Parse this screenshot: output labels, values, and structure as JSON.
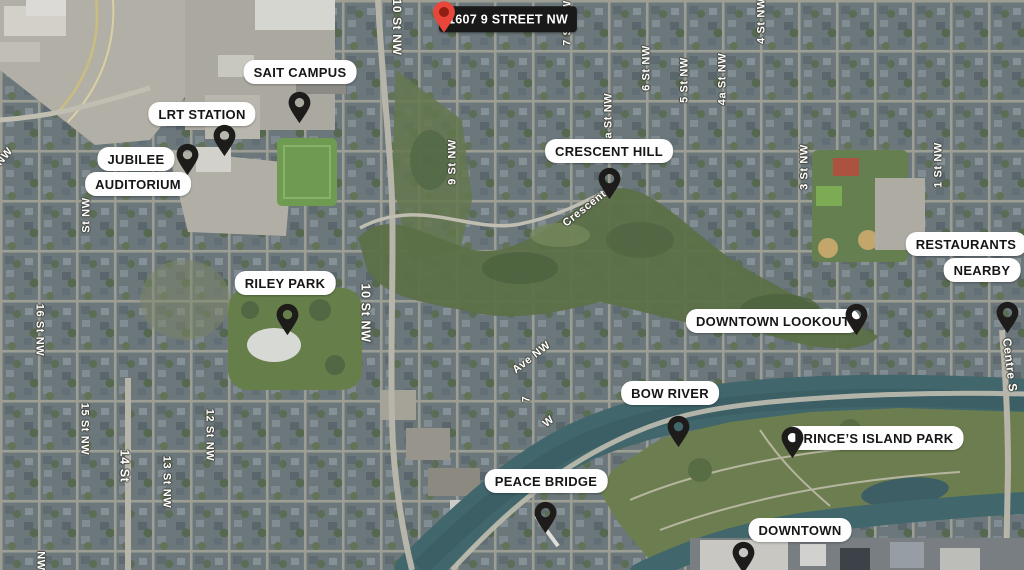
{
  "map": {
    "title": "1607 9 Street NW area map",
    "colors": {
      "pin_black": "#1d1c1a",
      "pin_red": "#e8463a",
      "pin_red_inner": "#8e1f12",
      "label_bg": "#fefefe",
      "label_text": "#161616",
      "address_bg": "#191919",
      "address_text": "#ffffff",
      "street_text": "#ffffff",
      "water": "#3f666b"
    },
    "markers": [
      {
        "name": "address-1607-9-street-nw",
        "pin": {
          "x": 444,
          "y": 34,
          "color": "red",
          "w": 28,
          "h": 34
        },
        "labels": [
          {
            "text": "1607 9 STREET NW",
            "x": 508,
            "y": 19,
            "style": "dark"
          }
        ]
      },
      {
        "name": "sait-campus",
        "pin": {
          "x": 299,
          "y": 125,
          "color": "black"
        },
        "labels": [
          {
            "text": "SAIT CAMPUS",
            "x": 300,
            "y": 72
          }
        ]
      },
      {
        "name": "lrt-station",
        "pin": {
          "x": 224,
          "y": 158,
          "color": "black"
        },
        "labels": [
          {
            "text": "LRT STATION",
            "x": 202,
            "y": 114
          }
        ]
      },
      {
        "name": "jubilee-auditorium",
        "pin": {
          "x": 187,
          "y": 177,
          "color": "black"
        },
        "labels": [
          {
            "text": "JUBILEE",
            "x": 136,
            "y": 159
          },
          {
            "text": "AUDITORIUM",
            "x": 138,
            "y": 184
          }
        ]
      },
      {
        "name": "crescent-hill",
        "pin": {
          "x": 609,
          "y": 201,
          "color": "black"
        },
        "labels": [
          {
            "text": "CRESCENT HILL",
            "x": 609,
            "y": 151
          }
        ]
      },
      {
        "name": "riley-park",
        "pin": {
          "x": 287,
          "y": 337,
          "color": "black"
        },
        "labels": [
          {
            "text": "RILEY PARK",
            "x": 285,
            "y": 283
          }
        ]
      },
      {
        "name": "downtown-lookout",
        "pin": {
          "x": 856,
          "y": 337,
          "color": "black"
        },
        "labels": [
          {
            "text": "DOWNTOWN LOOKOUT",
            "x": 773,
            "y": 321
          }
        ]
      },
      {
        "name": "restaurants-nearby",
        "pin": {
          "x": 1007,
          "y": 335,
          "color": "black"
        },
        "labels": [
          {
            "text": "RESTAURANTS",
            "x": 966,
            "y": 244
          },
          {
            "text": "NEARBY",
            "x": 982,
            "y": 270
          }
        ]
      },
      {
        "name": "bow-river",
        "pin": {
          "x": 678,
          "y": 449,
          "color": "black"
        },
        "labels": [
          {
            "text": "BOW RIVER",
            "x": 670,
            "y": 393
          }
        ]
      },
      {
        "name": "princes-island-park",
        "pin": {
          "x": 792,
          "y": 460,
          "color": "black"
        },
        "labels": [
          {
            "text": "PRINCE’S ISLAND PARK",
            "x": 874,
            "y": 438
          }
        ]
      },
      {
        "name": "peace-bridge",
        "pin": {
          "x": 545,
          "y": 535,
          "color": "black"
        },
        "labels": [
          {
            "text": "PEACE BRIDGE",
            "x": 546,
            "y": 481
          }
        ]
      },
      {
        "name": "downtown",
        "pin": {
          "x": 743,
          "y": 575,
          "color": "black"
        },
        "labels": [
          {
            "text": "DOWNTOWN",
            "x": 800,
            "y": 530
          }
        ]
      }
    ],
    "street_labels": [
      {
        "text": "10 St NW",
        "x": 397,
        "y": 27,
        "angle": 90,
        "size": 12
      },
      {
        "text": "9 St NW",
        "x": 453,
        "y": 162,
        "angle": -90,
        "size": 11
      },
      {
        "text": "7 St NW",
        "x": 568,
        "y": 23,
        "angle": -90,
        "size": 11
      },
      {
        "text": "6 St NW",
        "x": 647,
        "y": 68,
        "angle": -90,
        "size": 11
      },
      {
        "text": "6a St NW",
        "x": 609,
        "y": 119,
        "angle": -90,
        "size": 11
      },
      {
        "text": "5 St NW",
        "x": 685,
        "y": 80,
        "angle": -90,
        "size": 11
      },
      {
        "text": "4a St NW",
        "x": 723,
        "y": 79,
        "angle": -90,
        "size": 11
      },
      {
        "text": "4 St NW",
        "x": 762,
        "y": 21,
        "angle": -90,
        "size": 11
      },
      {
        "text": "3 St NW",
        "x": 805,
        "y": 167,
        "angle": -90,
        "size": 11
      },
      {
        "text": "1 St NW",
        "x": 939,
        "y": 165,
        "angle": -90,
        "size": 11
      },
      {
        "text": "Centre S",
        "x": 1010,
        "y": 365,
        "angle": 83,
        "size": 12
      },
      {
        "text": "NW",
        "x": 5,
        "y": 157,
        "angle": -50,
        "size": 11
      },
      {
        "text": "St NW",
        "x": 87,
        "y": 215,
        "angle": -90,
        "size": 11
      },
      {
        "text": "16 St NW",
        "x": 39,
        "y": 330,
        "angle": 90,
        "size": 11
      },
      {
        "text": "10 St NW",
        "x": 365,
        "y": 313,
        "angle": 90,
        "size": 12.5
      },
      {
        "text": "15 St NW",
        "x": 84,
        "y": 429,
        "angle": 90,
        "size": 11
      },
      {
        "text": "14 St",
        "x": 124,
        "y": 466,
        "angle": 90,
        "size": 12.5
      },
      {
        "text": "13 St NW",
        "x": 166,
        "y": 482,
        "angle": 90,
        "size": 11
      },
      {
        "text": "12 St NW",
        "x": 209,
        "y": 435,
        "angle": 90,
        "size": 11
      },
      {
        "text": "NW",
        "x": 40,
        "y": 561,
        "angle": 90,
        "size": 11
      },
      {
        "text": "Crescent",
        "x": 585,
        "y": 209,
        "angle": -38,
        "size": 11
      },
      {
        "text": "Ave NW",
        "x": 532,
        "y": 358,
        "angle": -38,
        "size": 11
      },
      {
        "text": "7",
        "x": 527,
        "y": 399,
        "angle": -90,
        "size": 11
      },
      {
        "text": "W",
        "x": 549,
        "y": 422,
        "angle": -40,
        "size": 11
      }
    ]
  }
}
